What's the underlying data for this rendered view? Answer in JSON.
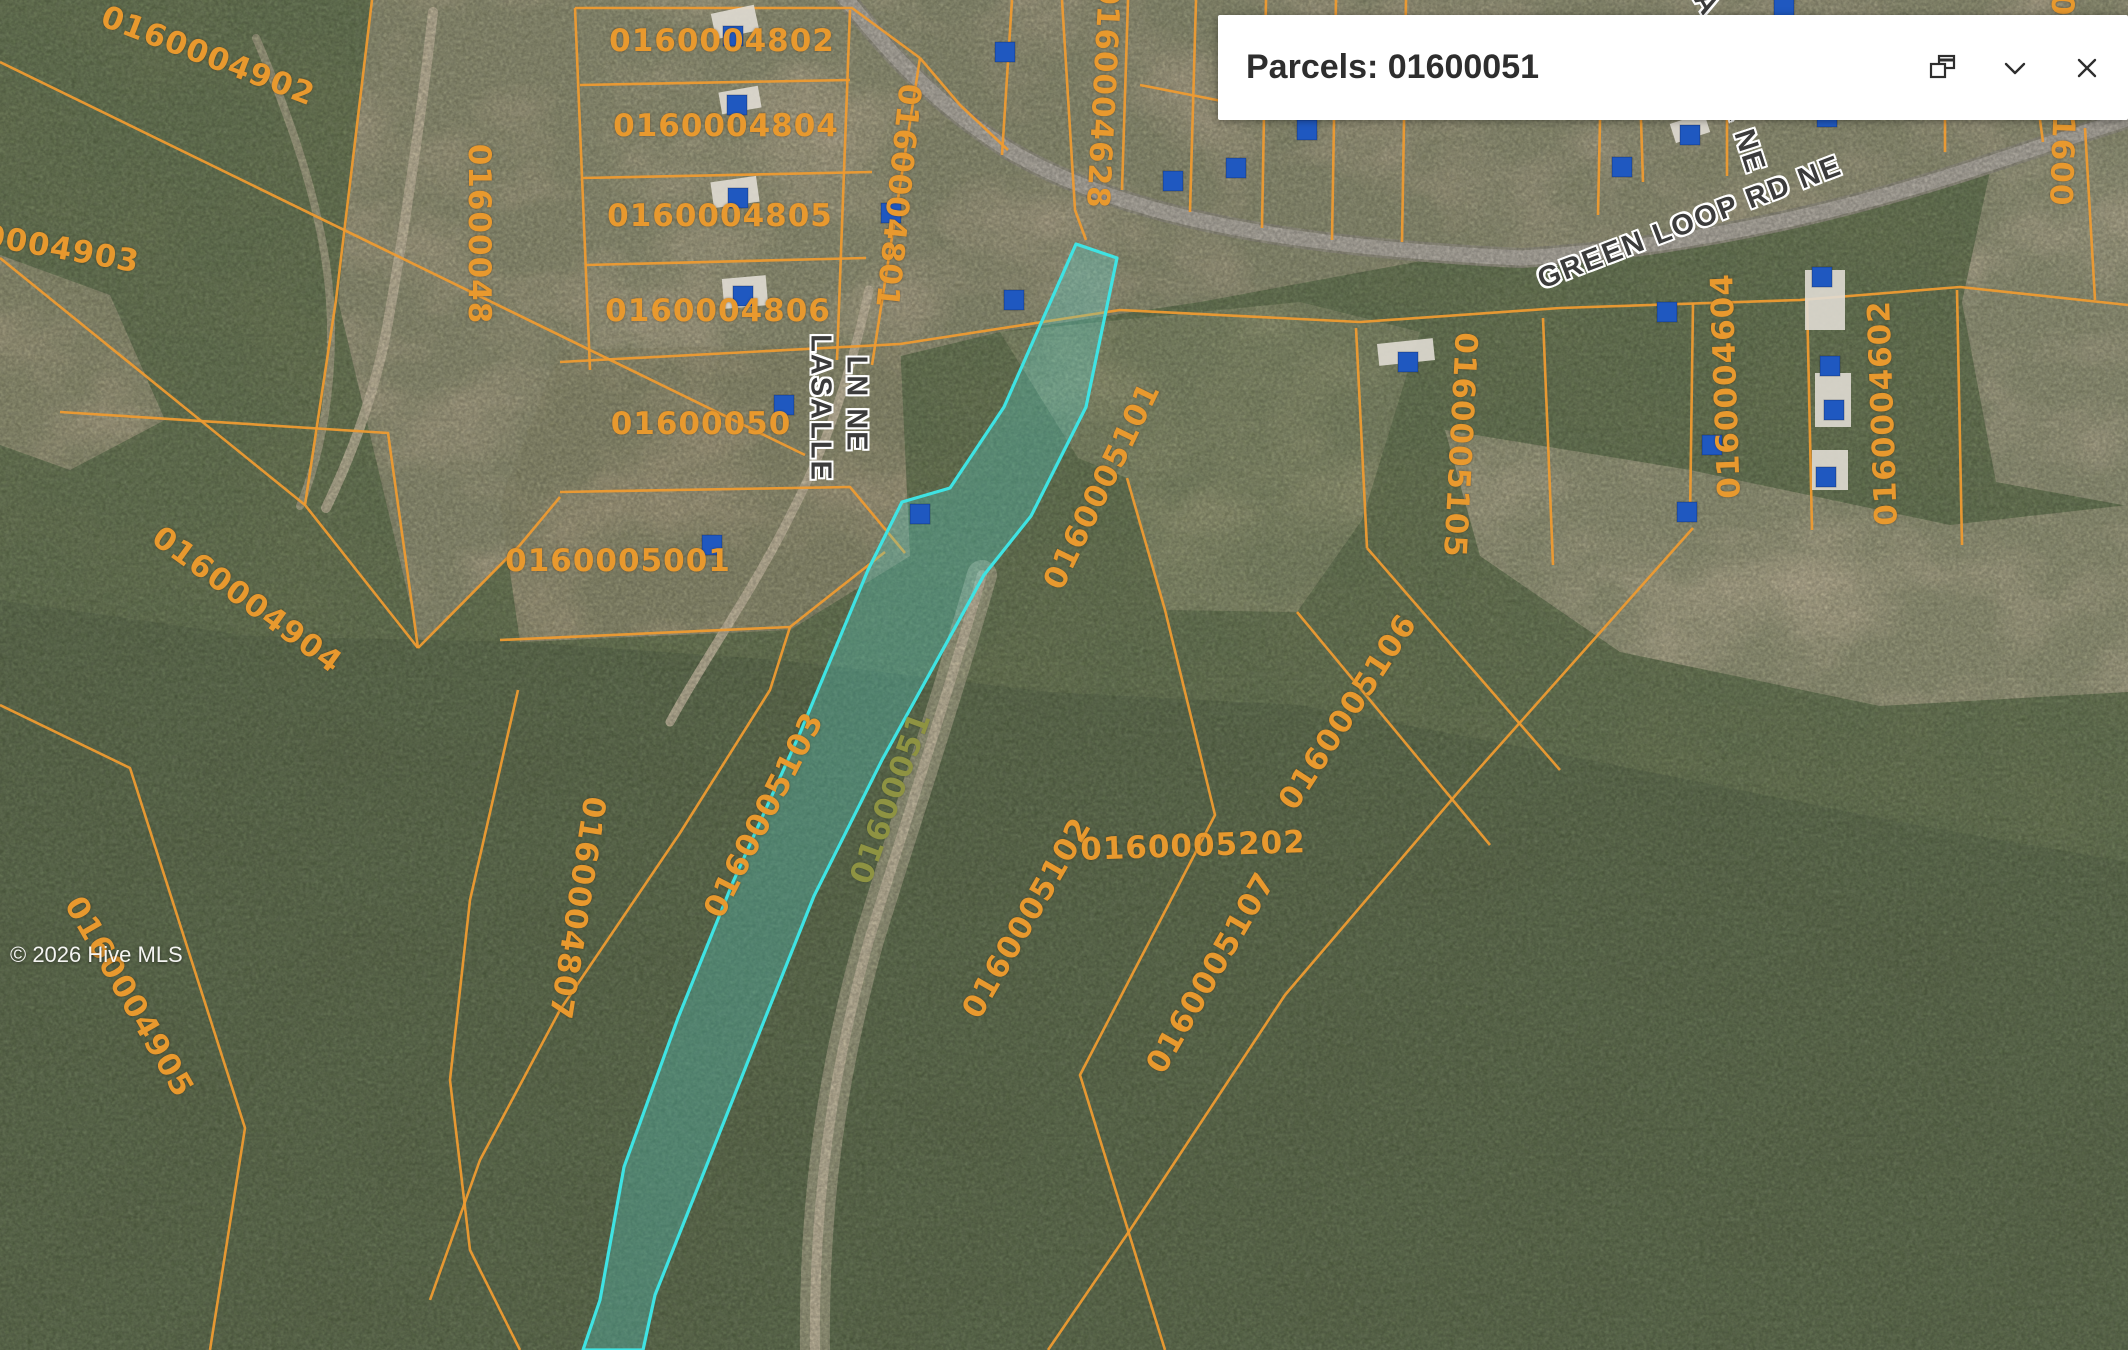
{
  "popup": {
    "title": "Parcels: 01600051",
    "dock_icon": "dock-icon",
    "collapse_icon": "chevron-down-icon",
    "close_icon": "close-icon"
  },
  "watermark": "© 2026 Hive MLS",
  "colors": {
    "boundary": "#EE9B31",
    "parcel_label": "#E8992E",
    "highlight_stroke": "#3FE3E3",
    "highlight_fill": "rgba(80,220,215,0.28)",
    "highlight_label": "#8e9342",
    "building": "#1F58C0",
    "road_fill": "#b3aea3",
    "road_casing": "#93907f",
    "base_terrain": "#6F7C55",
    "forest_dark": "#5d6b4a",
    "popup_bg": "#ffffff",
    "popup_text": "#2e2e2e"
  },
  "map": {
    "selected_parcel_id": "01600051",
    "parcel_labels": [
      {
        "t": "0160004902",
        "x": 208,
        "y": 56,
        "r": 21
      },
      {
        "t": "0160004903",
        "x": 28,
        "y": 243,
        "r": 10
      },
      {
        "t": "01600048",
        "x": 479,
        "y": 234,
        "r": 90
      },
      {
        "t": "0160004802",
        "x": 722,
        "y": 41,
        "r": 0
      },
      {
        "t": "0160004804",
        "x": 726,
        "y": 126,
        "r": 0
      },
      {
        "t": "0160004805",
        "x": 720,
        "y": 216,
        "r": 0
      },
      {
        "t": "0160004806",
        "x": 718,
        "y": 311,
        "r": 0
      },
      {
        "t": "0160004801",
        "x": 898,
        "y": 196,
        "r": 96
      },
      {
        "t": "0160004628",
        "x": 1103,
        "y": 96,
        "r": 93
      },
      {
        "t": "01600050",
        "x": 701,
        "y": 424,
        "r": 0
      },
      {
        "t": "0160005001",
        "x": 618,
        "y": 561,
        "r": 0
      },
      {
        "t": "0160004904",
        "x": 247,
        "y": 600,
        "r": 36
      },
      {
        "t": "0160004807",
        "x": 577,
        "y": 908,
        "r": 99
      },
      {
        "t": "0160005101",
        "x": 1102,
        "y": 486,
        "r": -64
      },
      {
        "t": "0160005103",
        "x": 764,
        "y": 815,
        "r": -63
      },
      {
        "t": "01600051",
        "x": 891,
        "y": 798,
        "r": -70,
        "hl": true
      },
      {
        "t": "0160005102",
        "x": 1027,
        "y": 918,
        "r": -60
      },
      {
        "t": "0160005105",
        "x": 1460,
        "y": 445,
        "r": 93
      },
      {
        "t": "0160005106",
        "x": 1348,
        "y": 712,
        "r": -57
      },
      {
        "t": "0160005107",
        "x": 1211,
        "y": 973,
        "r": -60
      },
      {
        "t": "0160004604",
        "x": 1726,
        "y": 386,
        "r": -92
      },
      {
        "t": "0160004602",
        "x": 1883,
        "y": 413,
        "r": -92
      },
      {
        "t": "0160004905",
        "x": 129,
        "y": 997,
        "r": 60
      },
      {
        "t": "0160005202",
        "x": 1193,
        "y": 846,
        "r": -2
      },
      {
        "t": "01600",
        "x": 2062,
        "y": 150,
        "r": 92
      },
      {
        "t": "0",
        "x": 2062,
        "y": 5,
        "r": 92
      }
    ],
    "road_labels": [
      {
        "t": "GREEN LOOP RD NE",
        "x": 1690,
        "y": 223,
        "r": -21,
        "s": 29
      },
      {
        "t": "LASALLE",
        "x": 820,
        "y": 408,
        "r": 90,
        "s": 29
      },
      {
        "t": "LN NE",
        "x": 856,
        "y": 404,
        "r": 90,
        "s": 29
      },
      {
        "t": "R NE",
        "x": 1744,
        "y": 136,
        "r": 72,
        "s": 29
      },
      {
        "t": "A",
        "x": 1706,
        "y": 4,
        "r": 60,
        "s": 29
      }
    ],
    "highlight_polygon": [
      [
        1076,
        244
      ],
      [
        1117,
        258
      ],
      [
        1086,
        407
      ],
      [
        1031,
        516
      ],
      [
        984,
        575
      ],
      [
        882,
        760
      ],
      [
        814,
        896
      ],
      [
        760,
        1031
      ],
      [
        706,
        1167
      ],
      [
        655,
        1295
      ],
      [
        643,
        1350
      ],
      [
        583,
        1350
      ],
      [
        600,
        1300
      ],
      [
        624,
        1167
      ],
      [
        678,
        1018
      ],
      [
        733,
        882
      ],
      [
        800,
        733
      ],
      [
        868,
        570
      ],
      [
        902,
        502
      ],
      [
        950,
        488
      ],
      [
        1004,
        407
      ]
    ],
    "boundaries": [
      [
        [
          0,
          62
        ],
        [
          805,
          455
        ]
      ],
      [
        [
          0,
          258
        ],
        [
          305,
          505
        ]
      ],
      [
        [
          372,
          0
        ],
        [
          336,
          300
        ],
        [
          305,
          505
        ],
        [
          418,
          648
        ]
      ],
      [
        [
          60,
          412
        ],
        [
          388,
          433
        ],
        [
          418,
          648
        ]
      ],
      [
        [
          418,
          648
        ],
        [
          520,
          545
        ],
        [
          560,
          497
        ]
      ],
      [
        [
          0,
          705
        ],
        [
          130,
          768
        ],
        [
          245,
          1128
        ],
        [
          210,
          1350
        ]
      ],
      [
        [
          575,
          8
        ],
        [
          852,
          8
        ],
        [
          920,
          58
        ]
      ],
      [
        [
          575,
          8
        ],
        [
          590,
          370
        ]
      ],
      [
        [
          580,
          85
        ],
        [
          850,
          80
        ]
      ],
      [
        [
          583,
          178
        ],
        [
          872,
          172
        ]
      ],
      [
        [
          586,
          265
        ],
        [
          866,
          258
        ]
      ],
      [
        [
          560,
          362
        ],
        [
          900,
          344
        ]
      ],
      [
        [
          850,
          10
        ],
        [
          837,
          360
        ]
      ],
      [
        [
          920,
          58
        ],
        [
          872,
          365
        ]
      ],
      [
        [
          920,
          58
        ],
        [
          960,
          105
        ],
        [
          1008,
          150
        ]
      ],
      [
        [
          560,
          492
        ],
        [
          850,
          487
        ],
        [
          905,
          553
        ]
      ],
      [
        [
          500,
          640
        ],
        [
          790,
          627
        ],
        [
          885,
          552
        ]
      ],
      [
        [
          790,
          627
        ],
        [
          770,
          690
        ],
        [
          680,
          833
        ],
        [
          560,
          1010
        ],
        [
          480,
          1160
        ],
        [
          430,
          1300
        ]
      ],
      [
        [
          518,
          690
        ],
        [
          470,
          900
        ],
        [
          450,
          1080
        ],
        [
          470,
          1250
        ],
        [
          520,
          1350
        ]
      ],
      [
        [
          1012,
          0
        ],
        [
          1002,
          155
        ]
      ],
      [
        [
          1062,
          0
        ],
        [
          1075,
          210
        ],
        [
          1086,
          240
        ]
      ],
      [
        [
          1128,
          0
        ],
        [
          1122,
          190
        ]
      ],
      [
        [
          1196,
          0
        ],
        [
          1190,
          212
        ]
      ],
      [
        [
          1266,
          0
        ],
        [
          1262,
          228
        ]
      ],
      [
        [
          1336,
          0
        ],
        [
          1332,
          240
        ]
      ],
      [
        [
          1406,
          0
        ],
        [
          1402,
          242
        ]
      ],
      [
        [
          1140,
          85
        ],
        [
          1232,
          103
        ]
      ],
      [
        [
          900,
          344
        ],
        [
          1120,
          310
        ],
        [
          1360,
          322
        ],
        [
          1560,
          308
        ],
        [
          1800,
          300
        ],
        [
          1960,
          287
        ],
        [
          2128,
          305
        ]
      ],
      [
        [
          1693,
          303
        ],
        [
          1690,
          520
        ]
      ],
      [
        [
          1807,
          298
        ],
        [
          1812,
          530
        ]
      ],
      [
        [
          1957,
          290
        ],
        [
          1962,
          545
        ]
      ],
      [
        [
          1356,
          328
        ],
        [
          1367,
          548
        ]
      ],
      [
        [
          1543,
          318
        ],
        [
          1553,
          565
        ]
      ],
      [
        [
          1367,
          548
        ],
        [
          1560,
          770
        ]
      ],
      [
        [
          1297,
          612
        ],
        [
          1490,
          845
        ]
      ],
      [
        [
          1693,
          528
        ],
        [
          1460,
          790
        ],
        [
          1285,
          995
        ],
        [
          1130,
          1230
        ],
        [
          1048,
          1350
        ]
      ],
      [
        [
          1127,
          478
        ],
        [
          1165,
          610
        ],
        [
          1215,
          815
        ],
        [
          1080,
          1075
        ],
        [
          1165,
          1350
        ]
      ],
      [
        [
          1600,
          120
        ],
        [
          1598,
          215
        ]
      ],
      [
        [
          1641,
          120
        ],
        [
          1643,
          182
        ]
      ],
      [
        [
          1727,
          120
        ],
        [
          1727,
          176
        ]
      ],
      [
        [
          1945,
          120
        ],
        [
          1945,
          152
        ]
      ],
      [
        [
          2040,
          120
        ],
        [
          2043,
          142
        ]
      ],
      [
        [
          2085,
          128
        ],
        [
          2095,
          300
        ]
      ]
    ],
    "buildings": [
      [
        733,
        36
      ],
      [
        1005,
        52
      ],
      [
        737,
        105
      ],
      [
        738,
        198
      ],
      [
        743,
        296
      ],
      [
        891,
        213
      ],
      [
        784,
        405
      ],
      [
        712,
        545
      ],
      [
        920,
        514
      ],
      [
        1014,
        300
      ],
      [
        1173,
        181
      ],
      [
        1236,
        168
      ],
      [
        1408,
        362
      ],
      [
        1690,
        135
      ],
      [
        1622,
        167
      ],
      [
        1827,
        117
      ],
      [
        1822,
        277
      ],
      [
        1667,
        312
      ],
      [
        1830,
        366
      ],
      [
        1834,
        410
      ],
      [
        1712,
        445
      ],
      [
        1826,
        477
      ],
      [
        1687,
        512
      ],
      [
        1307,
        130
      ],
      [
        1784,
        6
      ]
    ],
    "roofs": [
      {
        "x": 735,
        "y": 22,
        "w": 44,
        "h": 26,
        "r": -12
      },
      {
        "x": 740,
        "y": 100,
        "w": 40,
        "h": 22,
        "r": -10
      },
      {
        "x": 735,
        "y": 192,
        "w": 46,
        "h": 26,
        "r": -8
      },
      {
        "x": 745,
        "y": 292,
        "w": 44,
        "h": 30,
        "r": -5
      },
      {
        "x": 1825,
        "y": 300,
        "w": 40,
        "h": 60,
        "r": 0
      },
      {
        "x": 1833,
        "y": 400,
        "w": 36,
        "h": 54,
        "r": 0
      },
      {
        "x": 1830,
        "y": 470,
        "w": 36,
        "h": 40,
        "r": 0
      },
      {
        "x": 1690,
        "y": 128,
        "w": 36,
        "h": 20,
        "r": -18
      },
      {
        "x": 1406,
        "y": 352,
        "w": 56,
        "h": 22,
        "r": -6
      }
    ],
    "roads": [
      {
        "d": "M 836 -14 C 888 52 932 102 1012 152 C 1132 222 1312 248 1522 258 C 1732 244 1892 196 2006 158 C 2072 136 2112 124 2142 114",
        "w": 15,
        "casing": true
      },
      {
        "d": "M 869 290 C 852 368 830 438 794 508 C 754 590 707 654 670 722",
        "w": 9,
        "color": "#cdc0a5",
        "op": 0.85
      },
      {
        "d": "M 433 12 C 421 120 403 238 387 328 C 375 392 353 452 326 508",
        "w": 10,
        "color": "#ccbfa4",
        "op": 0.8
      },
      {
        "d": "M 982 575 C 946 700 906 820 869 940 C 833 1070 813 1200 815 1352",
        "w": 30,
        "color": "#c9bda2",
        "op": 0.55
      },
      {
        "d": "M 982 575 C 946 700 906 820 869 940 C 833 1070 813 1200 815 1352",
        "w": 10,
        "color": "#cdc1a6",
        "op": 0.8
      },
      {
        "d": "M 256 38 C 300 140 331 238 331 330 C 331 392 322 452 300 506",
        "w": 8,
        "color": "#c5b89c",
        "op": 0.6
      }
    ],
    "terrain_regions": [
      {
        "fill": "#c3b397",
        "pts": [
          [
            372,
            0
          ],
          [
            578,
            0
          ],
          [
            590,
            370
          ],
          [
            520,
            545
          ],
          [
            420,
            645
          ],
          [
            338,
            300
          ]
        ]
      },
      {
        "fill": "#c7b79b",
        "pts": [
          [
            578,
            0
          ],
          [
            922,
            0
          ],
          [
            930,
            62
          ],
          [
            876,
            362
          ],
          [
            590,
            370
          ]
        ]
      },
      {
        "fill": "#bfb095",
        "pts": [
          [
            922,
            0
          ],
          [
            1452,
            0
          ],
          [
            1470,
            252
          ],
          [
            1200,
            302
          ],
          [
            1000,
            332
          ],
          [
            876,
            362
          ],
          [
            920,
            58
          ]
        ]
      },
      {
        "fill": "#c4b49a",
        "pts": [
          [
            1452,
            0
          ],
          [
            2128,
            0
          ],
          [
            2128,
            142
          ],
          [
            1960,
            176
          ],
          [
            1700,
            236
          ],
          [
            1520,
            262
          ],
          [
            1470,
            252
          ]
        ]
      },
      {
        "fill": "#bcab8d",
        "pts": [
          [
            560,
            350
          ],
          [
            900,
            342
          ],
          [
            910,
            556
          ],
          [
            790,
            630
          ],
          [
            520,
            642
          ],
          [
            500,
            502
          ]
        ]
      },
      {
        "fill": "#a3a37d",
        "pts": [
          [
            1000,
            332
          ],
          [
            1300,
            302
          ],
          [
            1420,
            332
          ],
          [
            1362,
            520
          ],
          [
            1297,
            612
          ],
          [
            1165,
            610
          ],
          [
            1127,
            478
          ],
          [
            1078,
            458
          ]
        ]
      },
      {
        "fill": "#cabc9f",
        "pts": [
          [
            1445,
            430
          ],
          [
            1690,
            470
          ],
          [
            1950,
            525
          ],
          [
            2128,
            505
          ],
          [
            2128,
            692
          ],
          [
            1880,
            706
          ],
          [
            1620,
            652
          ],
          [
            1480,
            556
          ]
        ]
      },
      {
        "fill": "#c8ba9f",
        "pts": [
          [
            1992,
            162
          ],
          [
            2128,
            142
          ],
          [
            2128,
            506
          ],
          [
            1996,
            482
          ],
          [
            1962,
            302
          ]
        ]
      },
      {
        "fill": "#c2b294",
        "pts": [
          [
            0,
            255
          ],
          [
            110,
            295
          ],
          [
            165,
            420
          ],
          [
            70,
            470
          ],
          [
            0,
            445
          ]
        ]
      },
      {
        "fill": "#5d6b4a",
        "pts": [
          [
            0,
            600
          ],
          [
            250,
            636
          ],
          [
            520,
            642
          ],
          [
            780,
            660
          ],
          [
            1050,
            692
          ],
          [
            1300,
            705
          ],
          [
            1600,
            762
          ],
          [
            1900,
            822
          ],
          [
            2128,
            862
          ],
          [
            2128,
            1352
          ],
          [
            0,
            1352
          ]
        ]
      }
    ]
  }
}
